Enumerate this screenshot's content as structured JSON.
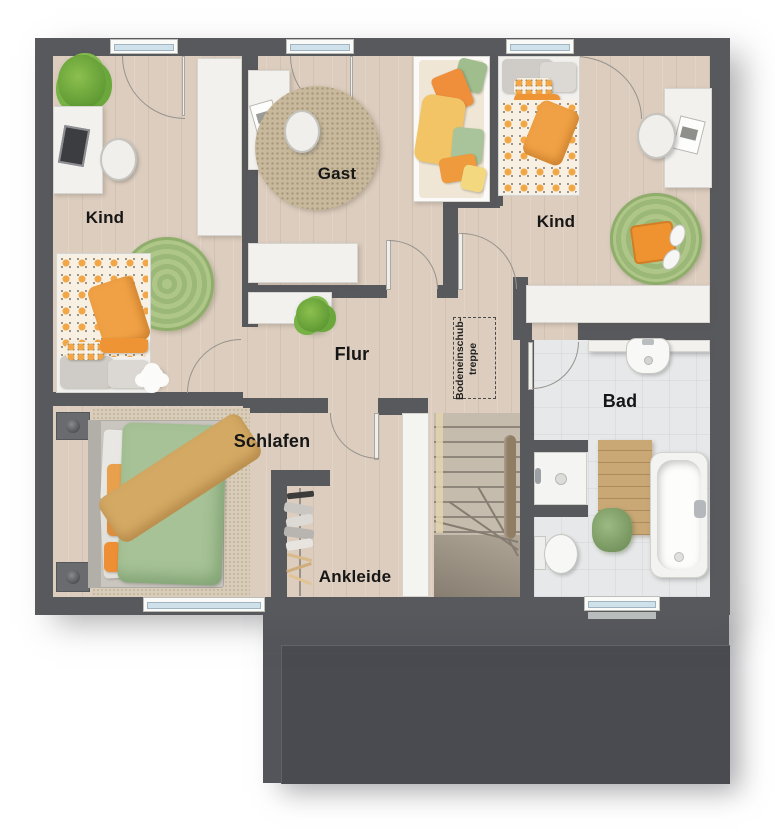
{
  "floorplan": {
    "rooms": [
      {
        "id": "kind-left",
        "label": "Kind"
      },
      {
        "id": "gast",
        "label": "Gast"
      },
      {
        "id": "kind-right",
        "label": "Kind"
      },
      {
        "id": "flur",
        "label": "Flur"
      },
      {
        "id": "schlafen",
        "label": "Schlafen"
      },
      {
        "id": "ankleide",
        "label": "Ankleide"
      },
      {
        "id": "bad",
        "label": "Bad"
      }
    ],
    "attic_stairs": {
      "line1": "Bodeneinschub-",
      "line2": "treppe"
    },
    "colors": {
      "wall": "#58595d",
      "floor_wood": "#dccdbe",
      "floor_tile": "#e6e8e9",
      "carpet": "#d9cdb9",
      "rug_green": "#a5c183",
      "rug_beige": "#c8b99c",
      "accent_orange": "#ef9d3e",
      "accent_green": "#a6c296",
      "accent_tan": "#d3a964",
      "furniture_white": "#f2f1ee",
      "lower_roof": "#54555a"
    }
  }
}
